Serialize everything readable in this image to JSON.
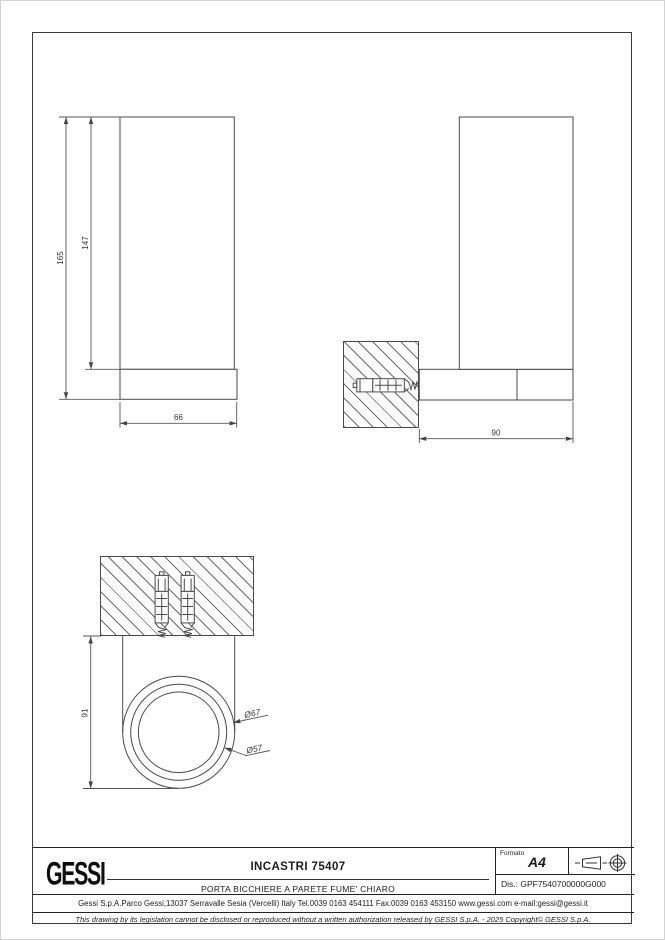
{
  "document": {
    "type": "technical-drawing-sheet"
  },
  "dims": {
    "front_total_height": "165",
    "front_body_height": "147",
    "front_width": "66",
    "side_depth": "90",
    "bottom_height": "91",
    "dia_outer": "Ø67",
    "dia_inner": "Ø57"
  },
  "title_block": {
    "logo": "GESSI",
    "title": "INCASTRI 75407",
    "subtitle": "PORTA BICCHIERE A PARETE FUME' CHIARO",
    "formato_label": "Formato",
    "formato_value": "A4",
    "dis": "Dis.: GPF7540700000G000",
    "address": "Gessi S.p.A.Parco Gessi,13037 Serravalle Sesia (Vercelli) Italy Tel.0039 0163 454111 Fax.0039 0163 453150 www.gessi.com e-mail:gessi@gessi.it",
    "legal": "This drawing by its legislation cannot be disclosed or reproduced without a written authorization released by GESSI S.p.A. - 2025 Copyright© GESSI S.p.A."
  }
}
